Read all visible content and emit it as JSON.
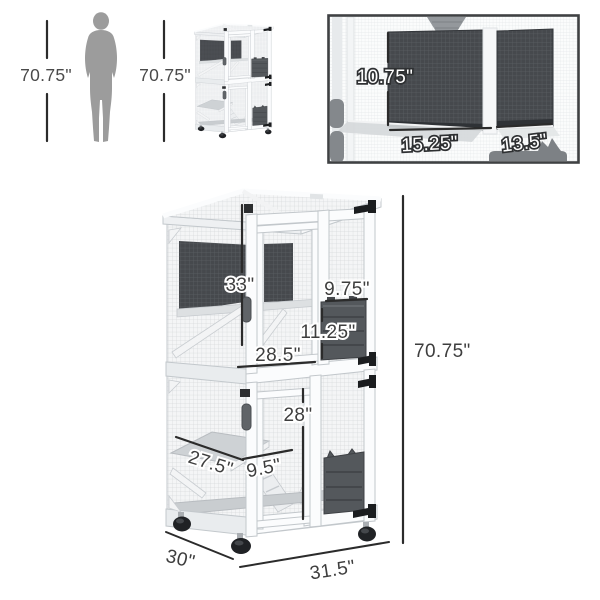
{
  "scale_comparison": {
    "human_height_label": "70.75\"",
    "thumbnail_height_label": "70.75\""
  },
  "inset_detail": {
    "hammock_height_label": "10.75\"",
    "large_platform_width_label": "15.25\"",
    "small_platform_width_label": "13.5\""
  },
  "main_diagram": {
    "upper_door_height_label": "33\"",
    "cat_bed_width_label": "9.75\"",
    "cat_bed_height_label": "11.25\"",
    "upper_interior_width_label": "28.5\"",
    "lower_door_height_label": "28\"",
    "platform_width_label": "27.5\"",
    "ramp_width_label": "9.5\"",
    "overall_height_label": "70.75\"",
    "overall_depth_label": "30\"",
    "overall_width_label": "31.5\""
  },
  "colors": {
    "dimension_text": "#3e3e3e",
    "dimension_line": "#2b2b2b",
    "inset_border": "#3f4143",
    "silhouette_gray": "#9c9c9c",
    "dark_mesh_panel": "#46494d",
    "cat_bed": "#54585c",
    "frame_white": "#fbfcfd"
  }
}
